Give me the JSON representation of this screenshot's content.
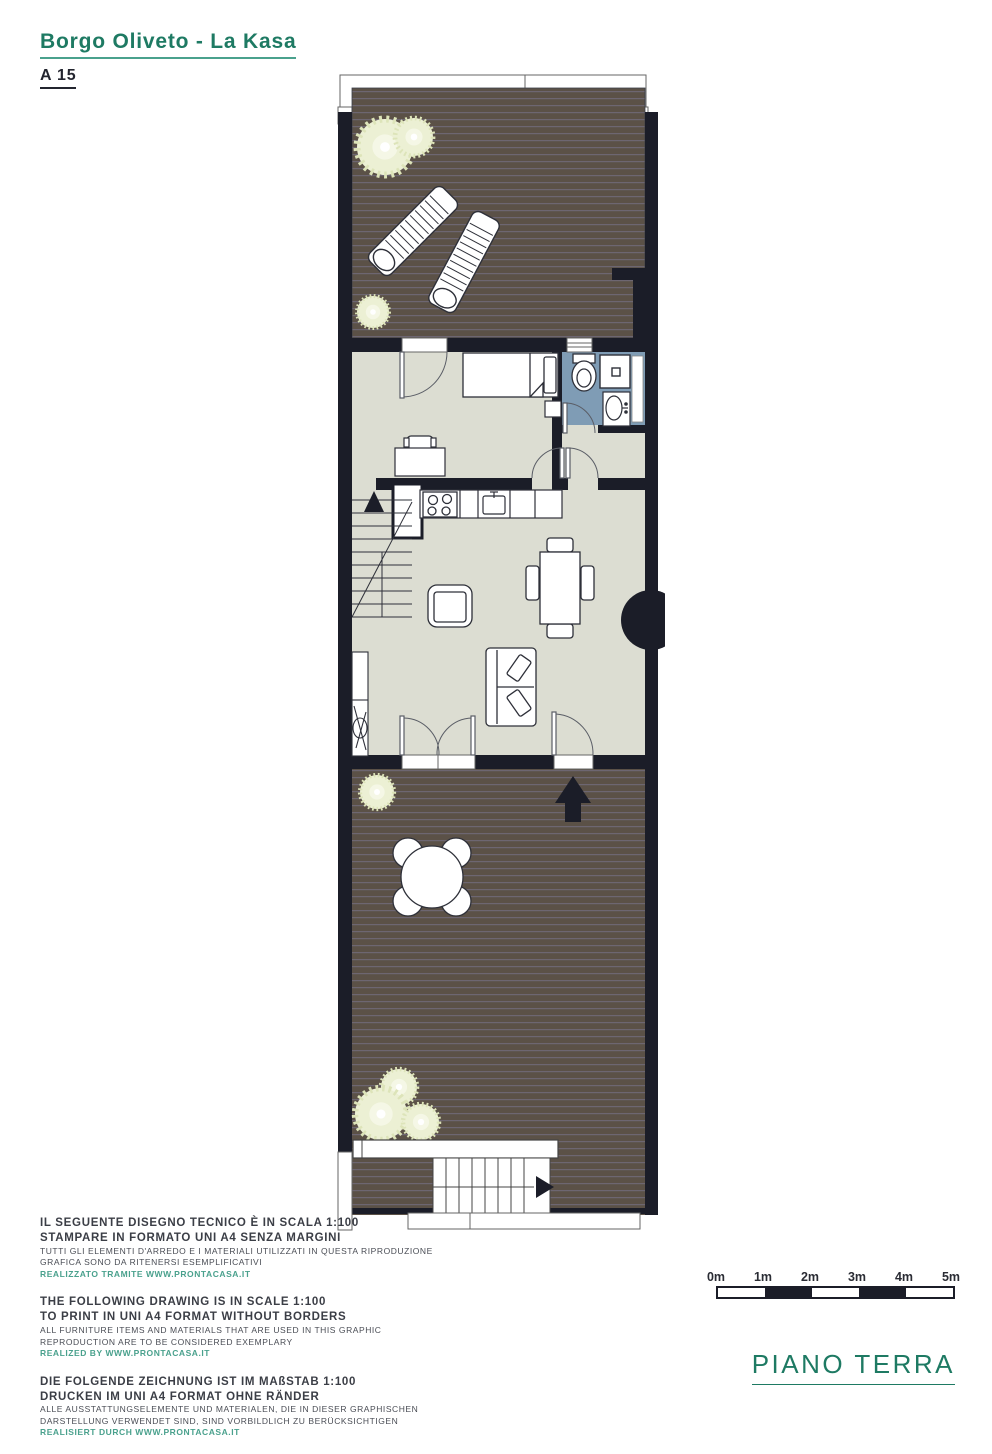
{
  "header": {
    "title": "Borgo Oliveto - La Kasa",
    "unit": "A 15"
  },
  "colors": {
    "accent_teal": "#1e7a63",
    "credit_teal": "#4aa18d",
    "wall": "#1b1d28",
    "deck_wood": "#5b5147",
    "deck_stripe": "#6d6671",
    "interior_floor": "#dcddd2",
    "bathroom_floor": "#7f9cb5",
    "plant_fill": "#ecf0d4"
  },
  "plan": {
    "floor_shown": "ground floor",
    "icons": [
      "sun-lounger-icon",
      "plant-icon",
      "bed-icon",
      "nightstand-icon",
      "desk-icon",
      "chair-icon",
      "toilet-icon",
      "shower-icon",
      "bathroom-sink-icon",
      "stove-icon",
      "kitchen-sink-icon",
      "fridge-icon",
      "stairs-up-icon",
      "dining-table-icon",
      "armchair-icon",
      "sofa-icon",
      "wardrobe-icon",
      "entry-arrow-icon",
      "round-table-icon",
      "bench-icon",
      "exterior-stairs-icon"
    ]
  },
  "disclaimers": [
    {
      "lang": "it",
      "bold": [
        "IL SEGUENTE DISEGNO TECNICO È IN SCALA 1:100",
        "STAMPARE IN FORMATO UNI A4 SENZA MARGINI"
      ],
      "small": [
        "TUTTI GLI ELEMENTI D'ARREDO E I MATERIALI UTILIZZATI IN QUESTA RIPRODUZIONE",
        "GRAFICA SONO DA RITENERSI ESEMPLIFICATIVI"
      ],
      "credit": "REALIZZATO TRAMITE WWW.PRONTACASA.IT"
    },
    {
      "lang": "en",
      "bold": [
        "THE FOLLOWING DRAWING IS IN SCALE 1:100",
        "TO PRINT IN UNI A4 FORMAT WITHOUT BORDERS"
      ],
      "small": [
        "ALL FURNITURE ITEMS AND MATERIALS THAT ARE USED IN THIS GRAPHIC",
        "REPRODUCTION ARE TO BE CONSIDERED EXEMPLARY"
      ],
      "credit": "REALIZED BY WWW.PRONTACASA.IT"
    },
    {
      "lang": "de",
      "bold": [
        "DIE FOLGENDE ZEICHNUNG IST IM MAßSTAB 1:100",
        "DRUCKEN IM UNI A4 FORMAT OHNE RÄNDER"
      ],
      "small": [
        "ALLE AUSSTATTUNGSELEMENTE UND MATERIALEN, DIE IN DIESER GRAPHISCHEN",
        "DARSTELLUNG VERWENDET SIND, SIND VORBILDLICH ZU BERÜCKSICHTIGEN"
      ],
      "credit": "REALISIERT DURCH WWW.PRONTACASA.IT"
    }
  ],
  "scale_bar": {
    "labels": [
      "0m",
      "1m",
      "2m",
      "3m",
      "4m",
      "5m"
    ],
    "segments": [
      "light",
      "dark",
      "light",
      "dark",
      "light"
    ]
  },
  "floor_label": "PIANO TERRA"
}
